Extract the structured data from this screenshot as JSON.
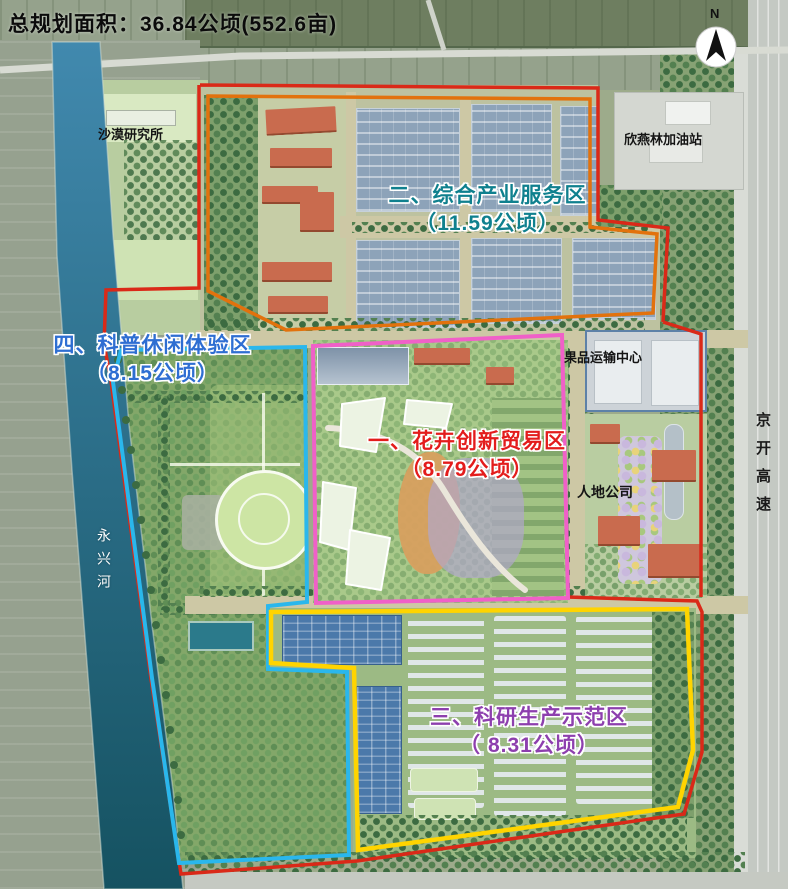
{
  "title": "总规划面积：36.84公顷(552.6亩)",
  "total_area_ha": 36.84,
  "total_area_mu": 552.6,
  "compass": {
    "label": "N"
  },
  "zones": [
    {
      "label": "一、花卉创新贸易区",
      "area_label": "（8.79公顷）",
      "area_ha": 8.79,
      "text_color": "#e31c1c",
      "outline_color": "#f060c8"
    },
    {
      "label": "二、综合产业服务区",
      "area_label": "（11.59公顷）",
      "area_ha": 11.59,
      "text_color": "#0f808e",
      "outline_color": "#e2720d"
    },
    {
      "label": "三、科研生产示范区",
      "area_label": "（ 8.31公顷）",
      "area_ha": 8.31,
      "text_color": "#8d3fae",
      "outline_color": "#ffd400"
    },
    {
      "label": "四、科普休闲体验区",
      "area_label": "（8.15公顷）",
      "area_ha": 8.15,
      "text_color": "#2e6ed2",
      "outline_color": "#2ab7ec"
    }
  ],
  "landmarks": {
    "research_institute": "沙漠研究所",
    "gas_station": "欣燕林加油站",
    "fruit_center": "果品运输中心",
    "rendi_company": "人地公司"
  },
  "river": {
    "name": "永兴河"
  },
  "highway": {
    "name": "京开高速"
  },
  "site_outline_color": "#da2918"
}
